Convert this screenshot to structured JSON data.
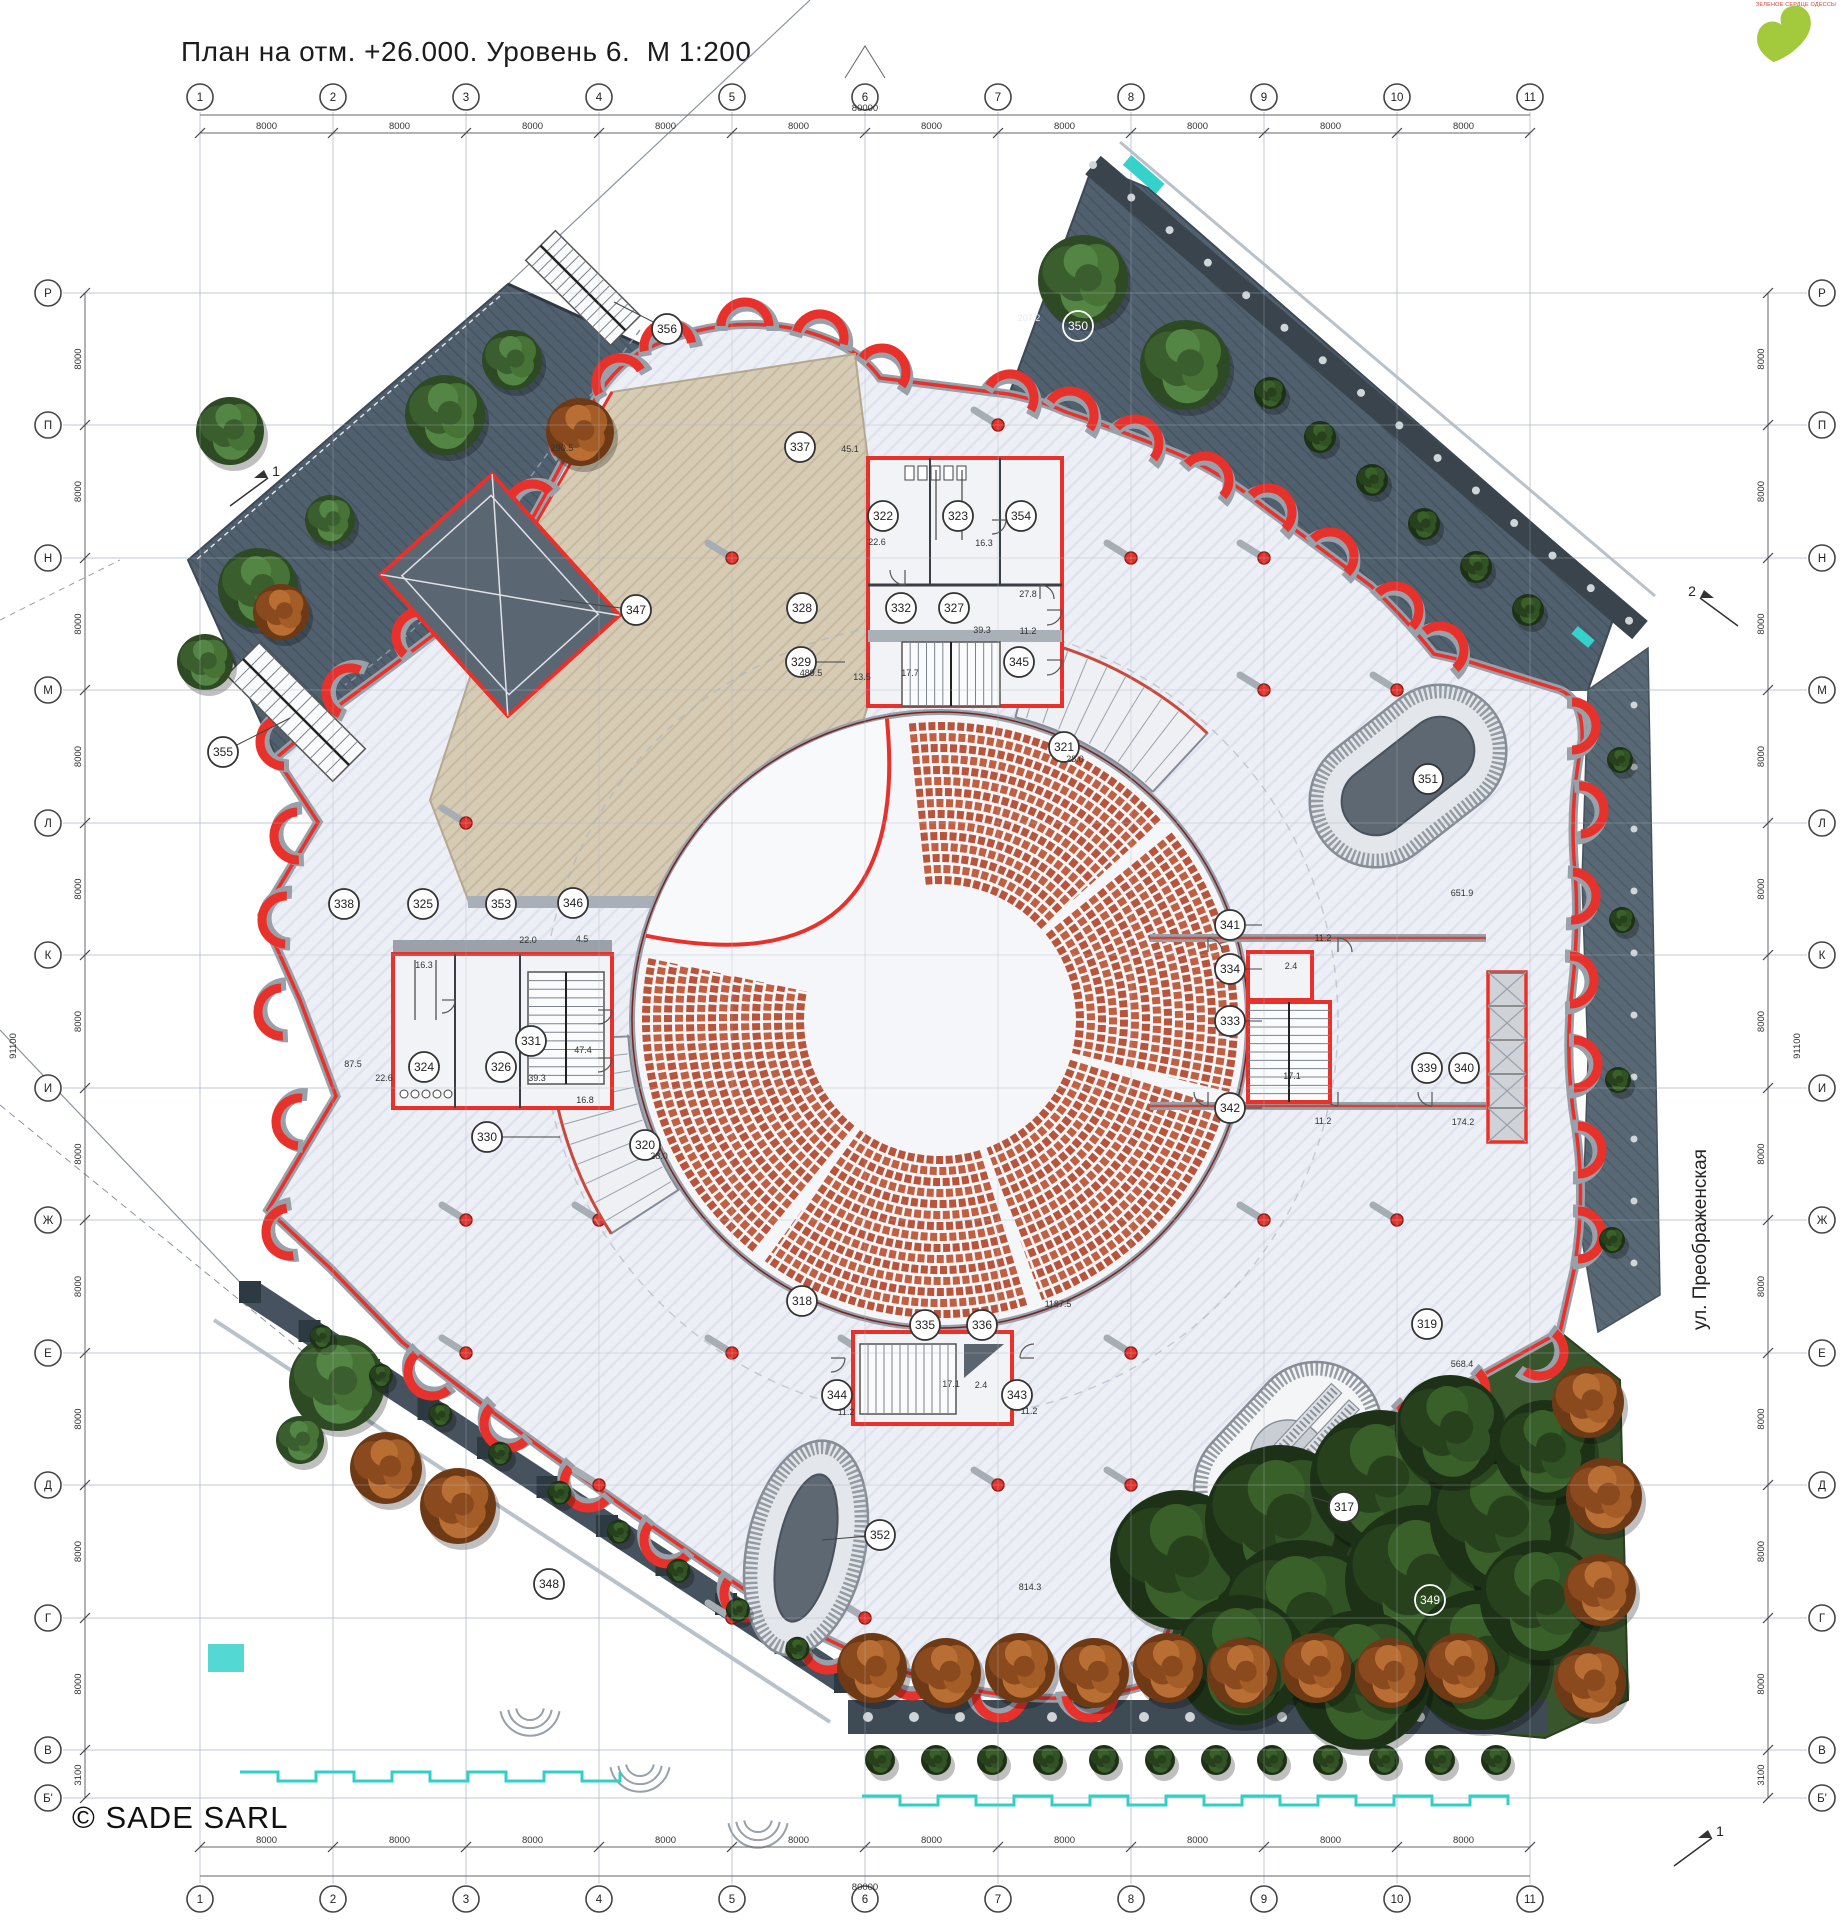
{
  "title": "План на отм. +26.000. Уровень 6.  М 1:200",
  "copyright": "© SADE SARL",
  "street_label": "ул. Преображенская",
  "logo": {
    "caption": "ЗЕЛЕНОЕ СЕРДЦЕ ОДЕССЫ",
    "color": "#a3c93d"
  },
  "colors": {
    "wall_red": "#e8312a",
    "wall_gray": "#98a0aa",
    "seat": "#c35f41",
    "deck": "#d6cbb4",
    "terrace": "#50606e",
    "floor": "#edeff6",
    "tree_green": "#3a5e2d",
    "tree_orange": "#a55d28",
    "teal": "#35d1cb"
  },
  "grid": {
    "columns": [
      "1",
      "2",
      "3",
      "4",
      "5",
      "6",
      "7",
      "8",
      "9",
      "10",
      "11"
    ],
    "rows": [
      "Р",
      "П",
      "Н",
      "М",
      "Л",
      "К",
      "И",
      "Ж",
      "Е",
      "Д",
      "Г",
      "В",
      "Б'"
    ],
    "bay_label": "8000",
    "last_bay_label": "3100",
    "total_width_label": "80000",
    "total_height_label": "91100"
  },
  "rooms": [
    {
      "n": "356",
      "x": 667,
      "y": 329
    },
    {
      "n": "350",
      "x": 1078,
      "y": 326,
      "light": true
    },
    {
      "n": "337",
      "x": 800,
      "y": 447
    },
    {
      "n": "322",
      "x": 883,
      "y": 516
    },
    {
      "n": "323",
      "x": 958,
      "y": 516
    },
    {
      "n": "354",
      "x": 1021,
      "y": 516
    },
    {
      "n": "347",
      "x": 636,
      "y": 610
    },
    {
      "n": "328",
      "x": 802,
      "y": 608
    },
    {
      "n": "332",
      "x": 901,
      "y": 608
    },
    {
      "n": "327",
      "x": 954,
      "y": 608
    },
    {
      "n": "329",
      "x": 801,
      "y": 662
    },
    {
      "n": "345",
      "x": 1019,
      "y": 662
    },
    {
      "n": "355",
      "x": 223,
      "y": 752
    },
    {
      "n": "321",
      "x": 1064,
      "y": 747
    },
    {
      "n": "351",
      "x": 1428,
      "y": 779
    },
    {
      "n": "338",
      "x": 344,
      "y": 904
    },
    {
      "n": "325",
      "x": 423,
      "y": 904
    },
    {
      "n": "353",
      "x": 501,
      "y": 904
    },
    {
      "n": "346",
      "x": 573,
      "y": 903
    },
    {
      "n": "341",
      "x": 1230,
      "y": 925
    },
    {
      "n": "334",
      "x": 1230,
      "y": 969
    },
    {
      "n": "333",
      "x": 1230,
      "y": 1021
    },
    {
      "n": "331",
      "x": 531,
      "y": 1041
    },
    {
      "n": "324",
      "x": 424,
      "y": 1067
    },
    {
      "n": "326",
      "x": 501,
      "y": 1067
    },
    {
      "n": "339",
      "x": 1427,
      "y": 1068
    },
    {
      "n": "340",
      "x": 1464,
      "y": 1068
    },
    {
      "n": "342",
      "x": 1230,
      "y": 1108
    },
    {
      "n": "330",
      "x": 487,
      "y": 1137
    },
    {
      "n": "320",
      "x": 645,
      "y": 1145
    },
    {
      "n": "318",
      "x": 802,
      "y": 1301
    },
    {
      "n": "319",
      "x": 1427,
      "y": 1324
    },
    {
      "n": "335",
      "x": 925,
      "y": 1325
    },
    {
      "n": "336",
      "x": 982,
      "y": 1325
    },
    {
      "n": "344",
      "x": 837,
      "y": 1395
    },
    {
      "n": "343",
      "x": 1017,
      "y": 1395
    },
    {
      "n": "348",
      "x": 549,
      "y": 1584
    },
    {
      "n": "317",
      "x": 1344,
      "y": 1507
    },
    {
      "n": "352",
      "x": 880,
      "y": 1535
    },
    {
      "n": "349",
      "x": 1430,
      "y": 1600,
      "light": true
    }
  ],
  "dimensions": [
    {
      "t": "45.1",
      "x": 850,
      "y": 452
    },
    {
      "t": "290.5",
      "x": 562,
      "y": 451
    },
    {
      "t": "207.2",
      "x": 1029,
      "y": 321,
      "light": true
    },
    {
      "t": "27.8",
      "x": 1028,
      "y": 597
    },
    {
      "t": "11.2",
      "x": 1028,
      "y": 634
    },
    {
      "t": "39.3",
      "x": 982,
      "y": 633
    },
    {
      "t": "22.6",
      "x": 877,
      "y": 545
    },
    {
      "t": "16.3",
      "x": 984,
      "y": 546
    },
    {
      "t": "489.5",
      "x": 811,
      "y": 676
    },
    {
      "t": "13.5",
      "x": 862,
      "y": 680
    },
    {
      "t": "17.7",
      "x": 910,
      "y": 676
    },
    {
      "t": "22.0",
      "x": 528,
      "y": 943
    },
    {
      "t": "4.5",
      "x": 582,
      "y": 942
    },
    {
      "t": "16.3",
      "x": 424,
      "y": 968
    },
    {
      "t": "87.5",
      "x": 353,
      "y": 1067
    },
    {
      "t": "22.6",
      "x": 384,
      "y": 1081
    },
    {
      "t": "39.3",
      "x": 537,
      "y": 1081
    },
    {
      "t": "16.8",
      "x": 585,
      "y": 1103
    },
    {
      "t": "47.4",
      "x": 583,
      "y": 1053
    },
    {
      "t": "28.0",
      "x": 1075,
      "y": 762
    },
    {
      "t": "28.0",
      "x": 659,
      "y": 1159
    },
    {
      "t": "651.9",
      "x": 1462,
      "y": 896
    },
    {
      "t": "11.2",
      "x": 1323,
      "y": 941
    },
    {
      "t": "2.4",
      "x": 1291,
      "y": 969
    },
    {
      "t": "17.1",
      "x": 1292,
      "y": 1079
    },
    {
      "t": "11.2",
      "x": 1323,
      "y": 1124
    },
    {
      "t": "174.2",
      "x": 1463,
      "y": 1125
    },
    {
      "t": "1187.5",
      "x": 1058,
      "y": 1307
    },
    {
      "t": "17.1",
      "x": 951,
      "y": 1387
    },
    {
      "t": "2.4",
      "x": 981,
      "y": 1388
    },
    {
      "t": "11.2",
      "x": 846,
      "y": 1415
    },
    {
      "t": "11.2",
      "x": 1029,
      "y": 1414
    },
    {
      "t": "568.4",
      "x": 1462,
      "y": 1367
    },
    {
      "t": "814.3",
      "x": 1030,
      "y": 1590
    }
  ],
  "section_marks": [
    {
      "label": "1",
      "x": 250,
      "y": 492
    },
    {
      "label": "2",
      "x": 1718,
      "y": 612
    },
    {
      "label": "1",
      "x": 1694,
      "y": 1852
    }
  ]
}
